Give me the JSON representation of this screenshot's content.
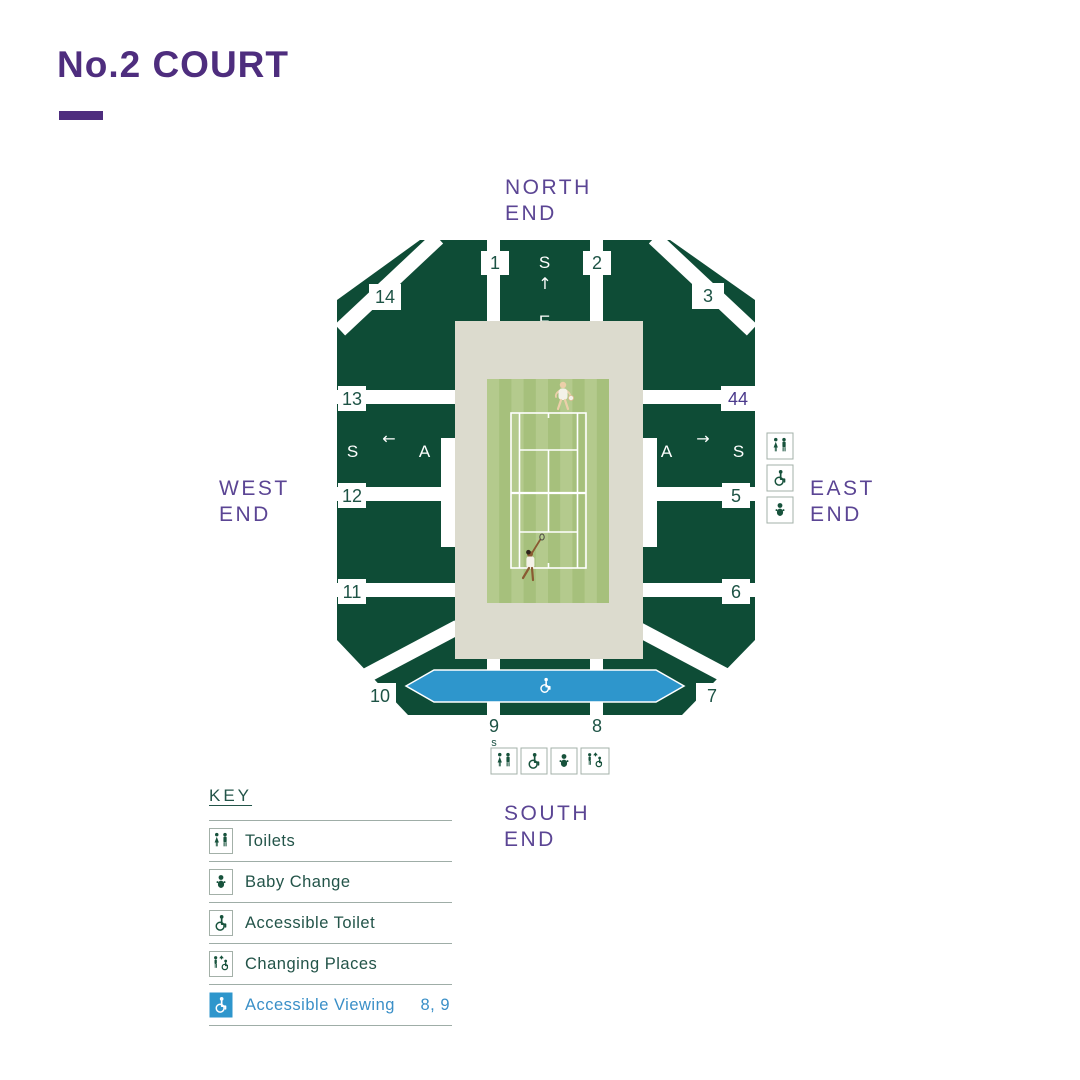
{
  "page": {
    "heading": "No.2 COURT"
  },
  "ends": {
    "north": [
      "NORTH",
      "END"
    ],
    "west": [
      "WEST",
      "END"
    ],
    "east": [
      "EAST",
      "END"
    ],
    "south": [
      "SOUTH",
      "END"
    ]
  },
  "map": {
    "sections": {
      "s1": "1",
      "s2": "2",
      "s3": "3",
      "s5": "5",
      "s6": "6",
      "s7": "7",
      "s8": "8",
      "s9": "9",
      "s10": "10",
      "s11": "11",
      "s12": "12",
      "s13": "13",
      "s14": "14",
      "s44": "44"
    },
    "stairs_marker": "s",
    "stand_letters": {
      "north_s": "S",
      "north_arrow": "↑",
      "north_e": "E",
      "west_s": "S",
      "west_arrow": "←",
      "west_a": "A",
      "east_a": "A",
      "east_arrow": "→",
      "east_s": "S"
    }
  },
  "legend": {
    "title": "KEY",
    "items": [
      {
        "icon": "toilets-icon",
        "label": "Toilets"
      },
      {
        "icon": "baby-change-icon",
        "label": "Baby Change"
      },
      {
        "icon": "accessible-toilet-icon",
        "label": "Accessible Toilet"
      },
      {
        "icon": "changing-places-icon",
        "label": "Changing Places"
      },
      {
        "icon": "accessible-viewing-icon",
        "label": "Accessible Viewing",
        "sections": "8, 9"
      }
    ]
  },
  "colors": {
    "purple": "#4e2d7e",
    "end_label_purple": "#5b4594",
    "stand_green": "#0e4c36",
    "text_green": "#1d5345",
    "beige": "#dcdbce",
    "court_green": "#a6c07c",
    "court_stripe": "#b4ca8d",
    "accessible_blue": "#2e96cc",
    "legend_blue": "#3a8fc7"
  }
}
